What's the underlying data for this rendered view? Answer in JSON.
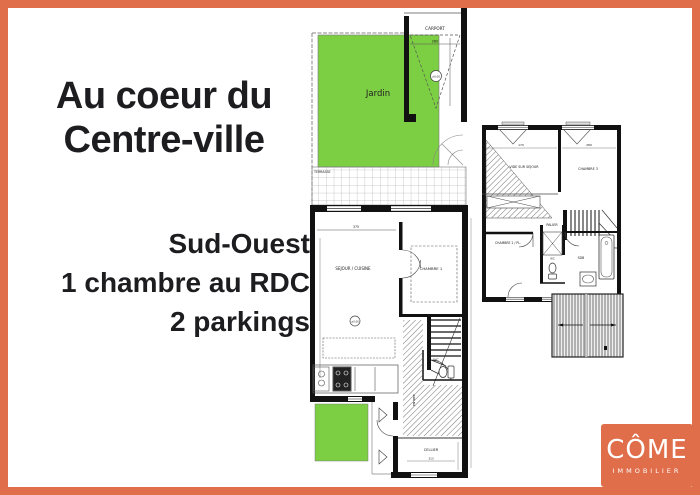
{
  "colors": {
    "accent": "#e06e4b",
    "garden": "#7cce43",
    "ink": "#1d1d20",
    "line": "#333333"
  },
  "headline": {
    "line1": "Au coeur du",
    "line2": "Centre-ville"
  },
  "features": {
    "orientation": "Sud-Ouest",
    "bedroom": "1 chambre au RDC",
    "parking": "2 parkings"
  },
  "ground_floor": {
    "jardin": "Jardin",
    "carport": "CARPORT",
    "terrasse": "TERRASSE",
    "sejour": "SEJOUR / CUISINE",
    "chambre1": "CHAMBRE 1",
    "wc": "WC",
    "entree": "ENTREE",
    "cellier": "CELLIER",
    "level_carport": "±0.00",
    "level_sejour": "±0.00",
    "dim_carport": "260",
    "dim_sejour": "375",
    "dim_cellier": "313"
  },
  "first_floor": {
    "vide": "VIDE SUR SEJOUR",
    "chambre3": "CHAMBRE 3",
    "palier": "PALIER",
    "chambre2": "CHAMBRE 2 / PL.",
    "wc": "WC",
    "sdb": "SDB",
    "dim_left": "170",
    "dim_right": "280"
  },
  "logo": {
    "brand": "CÔME",
    "subtitle": "IMMOBILIER"
  }
}
